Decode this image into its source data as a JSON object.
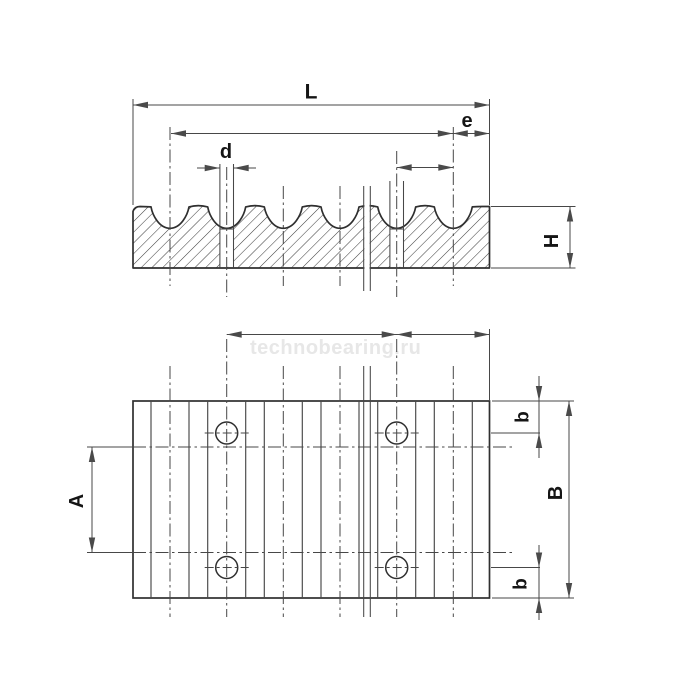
{
  "watermark": {
    "text": "technobearing.ru"
  },
  "colors": {
    "background": "#ffffff",
    "object_line": "#2f2f2f",
    "thin_line": "#474747",
    "dimension_line": "#4a4a4a",
    "hatch_line": "#3f3f3f",
    "label": "#151515",
    "watermark": "#e7e7e7"
  },
  "dimension_labels": [
    {
      "id": "L",
      "label": "L"
    },
    {
      "id": "e",
      "label": "e"
    },
    {
      "id": "d",
      "label": "d"
    },
    {
      "id": "H",
      "label": "H"
    },
    {
      "id": "A",
      "label": "A"
    },
    {
      "id": "B",
      "label": "B"
    },
    {
      "id": "b_top",
      "label": "b"
    },
    {
      "id": "b_bottom",
      "label": "b"
    }
  ]
}
